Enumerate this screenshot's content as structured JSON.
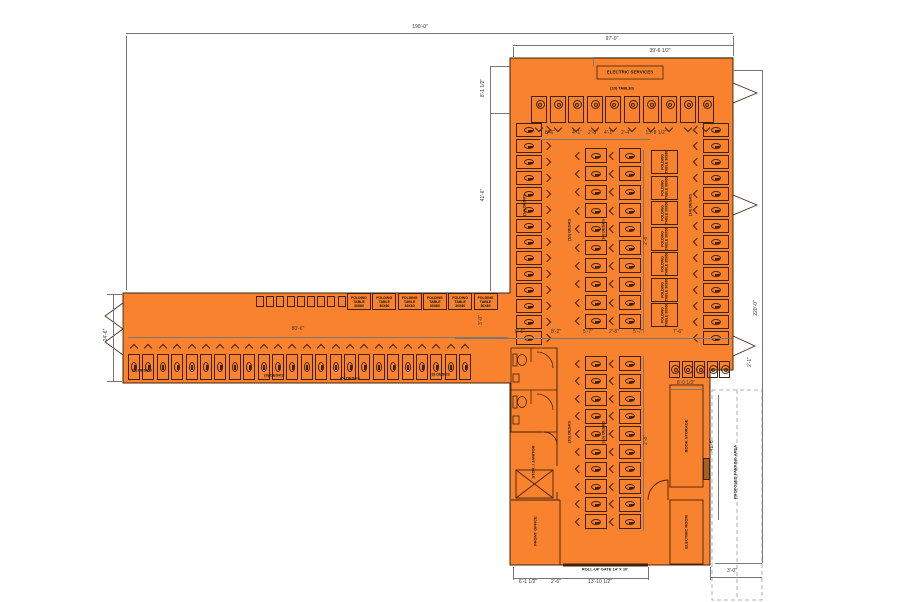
{
  "colors": {
    "building_fill": "#F9822E",
    "wall_line": "#40220a",
    "dimension_line": "#777777",
    "text": "#1a1a1a",
    "parking_dash": "#999999",
    "hatch_fill": "#A85F1F"
  },
  "room_labels": [
    {
      "t": "ELECTRIC SERVICES",
      "x": 630,
      "y": 72,
      "s": 4.5,
      "r": 0
    },
    {
      "t": "(10) TABLES",
      "x": 622,
      "y": 88,
      "s": 4,
      "r": 0
    },
    {
      "t": "ROLL-UP GATE 14' X 10'",
      "x": 605,
      "y": 569,
      "s": 4,
      "r": 0
    },
    {
      "t": "PROPOSED PARKING AREA",
      "x": 735,
      "y": 472,
      "s": 4,
      "r": -90
    },
    {
      "t": "BOOK STORAGE",
      "x": 686,
      "y": 436,
      "s": 4,
      "r": -90
    },
    {
      "t": "ELECTRIC ROOM",
      "x": 686,
      "y": 532,
      "s": 4,
      "r": -90
    },
    {
      "t": "STOR. / JANITOR",
      "x": 533,
      "y": 462,
      "s": 4,
      "r": -90
    },
    {
      "t": "FRONT OFFICE",
      "x": 535,
      "y": 531,
      "s": 4,
      "r": -90
    },
    {
      "t": "(6) DESKS",
      "x": 142,
      "y": 370,
      "s": 4,
      "r": 0
    },
    {
      "t": "(8) DESKS",
      "x": 274,
      "y": 375,
      "s": 4,
      "r": 0
    },
    {
      "t": "(5) DESKS",
      "x": 350,
      "y": 378,
      "s": 4,
      "r": 0
    },
    {
      "t": "(8) DESKS",
      "x": 440,
      "y": 374,
      "s": 4,
      "r": 0
    },
    {
      "t": "(14) DESKS",
      "x": 524,
      "y": 205,
      "s": 4,
      "r": -90
    },
    {
      "t": "(14) DESKS",
      "x": 690,
      "y": 205,
      "s": 4,
      "r": -90
    },
    {
      "t": "(10) DESKS",
      "x": 569,
      "y": 230,
      "s": 4,
      "r": -90
    },
    {
      "t": "(10) DESKS",
      "x": 603,
      "y": 230,
      "s": 4,
      "r": -90
    },
    {
      "t": "(10) DESKS",
      "x": 569,
      "y": 432,
      "s": 4,
      "r": -90
    },
    {
      "t": "(10) DESKS",
      "x": 603,
      "y": 432,
      "s": 4,
      "r": -90
    }
  ],
  "dim_labels": [
    {
      "t": "190'-0\"",
      "x": 420,
      "y": 27,
      "r": 0
    },
    {
      "t": "97'-0\"",
      "x": 612,
      "y": 39,
      "r": 0
    },
    {
      "t": "39'-6 1/2\"",
      "x": 660,
      "y": 51,
      "r": 0
    },
    {
      "t": "8'-1 1/2\"",
      "x": 483,
      "y": 88,
      "r": -90
    },
    {
      "t": "41'-6\"",
      "x": 483,
      "y": 195,
      "r": -90
    },
    {
      "t": "24'-6\"",
      "x": 106,
      "y": 335,
      "r": -90
    },
    {
      "t": "220'-0\"",
      "x": 756,
      "y": 308,
      "r": -90
    },
    {
      "t": "80'-6\"",
      "x": 298,
      "y": 329,
      "r": 0
    },
    {
      "t": "8'-6\"",
      "x": 550,
      "y": 133,
      "r": 0
    },
    {
      "t": "4'-1\"",
      "x": 577,
      "y": 133,
      "r": 0
    },
    {
      "t": "2'-8\"",
      "x": 593,
      "y": 133,
      "r": 0
    },
    {
      "t": "4'-1\"",
      "x": 609,
      "y": 133,
      "r": 0
    },
    {
      "t": "2'-4\"",
      "x": 626,
      "y": 133,
      "r": 0
    },
    {
      "t": "13'-8 1/2\"",
      "x": 656,
      "y": 133,
      "r": 0
    },
    {
      "t": "3'-0\"",
      "x": 481,
      "y": 320,
      "r": -90
    },
    {
      "t": "8'-6\"",
      "x": 520,
      "y": 332,
      "r": 0
    },
    {
      "t": "8'-2\"",
      "x": 556,
      "y": 332,
      "r": 0
    },
    {
      "t": "5'-7\"",
      "x": 588,
      "y": 332,
      "r": 0
    },
    {
      "t": "2'-8\"",
      "x": 614,
      "y": 332,
      "r": 0
    },
    {
      "t": "5'-7\"",
      "x": 638,
      "y": 332,
      "r": 0
    },
    {
      "t": "7'-6\"",
      "x": 678,
      "y": 332,
      "r": 0
    },
    {
      "t": "2'-8\"",
      "x": 646,
      "y": 240,
      "r": -90
    },
    {
      "t": "2'-8\"",
      "x": 646,
      "y": 440,
      "r": -90
    },
    {
      "t": "6'-1 1/2\"",
      "x": 528,
      "y": 582,
      "r": 0
    },
    {
      "t": "2'-6\"",
      "x": 556,
      "y": 582,
      "r": 0
    },
    {
      "t": "13'-10 1/2\"",
      "x": 600,
      "y": 582,
      "r": 0
    },
    {
      "t": "3'-0\"",
      "x": 732,
      "y": 571,
      "r": 0
    },
    {
      "t": "8'-0 1/2\"",
      "x": 686,
      "y": 383,
      "r": 0
    },
    {
      "t": "41'-6\"",
      "x": 712,
      "y": 445,
      "r": -90
    },
    {
      "t": "2'-1\"",
      "x": 750,
      "y": 362,
      "r": -90
    }
  ],
  "dim_lines": [
    {
      "x": 126,
      "y": 33,
      "len": 607,
      "dir": "h"
    },
    {
      "x": 513,
      "y": 45,
      "len": 220,
      "dir": "h"
    },
    {
      "x": 593,
      "y": 57,
      "len": 140,
      "dir": "h"
    },
    {
      "x": 126,
      "y": 36,
      "len": 254,
      "dir": "v"
    },
    {
      "x": 733,
      "y": 36,
      "len": 20,
      "dir": "v"
    },
    {
      "x": 513,
      "y": 47,
      "len": 10,
      "dir": "v"
    },
    {
      "x": 593,
      "y": 59,
      "len": 7,
      "dir": "v"
    },
    {
      "x": 490,
      "y": 66,
      "len": 47,
      "dir": "v"
    },
    {
      "x": 490,
      "y": 113,
      "len": 178,
      "dir": "v"
    },
    {
      "x": 490,
      "y": 66,
      "len": 20,
      "dir": "h"
    },
    {
      "x": 490,
      "y": 113,
      "len": 20,
      "dir": "h"
    },
    {
      "x": 113,
      "y": 295,
      "len": 86,
      "dir": "v"
    },
    {
      "x": 107,
      "y": 294,
      "len": 15,
      "dir": "h"
    },
    {
      "x": 107,
      "y": 381,
      "len": 15,
      "dir": "h"
    },
    {
      "x": 762,
      "y": 70,
      "len": 493,
      "dir": "v"
    },
    {
      "x": 733,
      "y": 70,
      "len": 29,
      "dir": "h"
    },
    {
      "x": 715,
      "y": 563,
      "len": 47,
      "dir": "h"
    },
    {
      "x": 128,
      "y": 337,
      "len": 380,
      "dir": "h"
    },
    {
      "x": 455,
      "y": 338,
      "len": 278,
      "dir": "h"
    },
    {
      "x": 540,
      "y": 139,
      "len": 110,
      "dir": "h"
    },
    {
      "x": 643,
      "y": 150,
      "len": 183,
      "dir": "v"
    },
    {
      "x": 643,
      "y": 356,
      "len": 175,
      "dir": "v"
    },
    {
      "x": 513,
      "y": 578,
      "len": 135,
      "dir": "h"
    },
    {
      "x": 513,
      "y": 567,
      "len": 13,
      "dir": "v"
    },
    {
      "x": 648,
      "y": 567,
      "len": 13,
      "dir": "v"
    },
    {
      "x": 710,
      "y": 577,
      "len": 52,
      "dir": "h"
    },
    {
      "x": 710,
      "y": 567,
      "len": 13,
      "dir": "v"
    },
    {
      "x": 670,
      "y": 389,
      "len": 33,
      "dir": "h"
    },
    {
      "x": 718,
      "y": 395,
      "len": 125,
      "dir": "v"
    }
  ],
  "furniture": {
    "rows": [
      {
        "name": "wing-desk-row",
        "type": "desk",
        "orient": "up",
        "x": 128,
        "y": 345,
        "count": 24,
        "pitch": 14.4,
        "w": 12,
        "h": 26
      },
      {
        "name": "wing-lockers",
        "type": "locker",
        "x": 256,
        "y": 296,
        "count": 9,
        "pitch": 10.2,
        "w": 8,
        "h": 11
      },
      {
        "name": "wing-folding-tables",
        "type": "htable",
        "x": 347,
        "y": 293,
        "count": 6,
        "pitch": 25.3,
        "w": 24,
        "h": 17,
        "label": "FOLDING TABLE 30X60"
      },
      {
        "name": "hall-top-tables",
        "type": "tcircle",
        "orient": "down",
        "x": 531,
        "y": 96,
        "count": 10,
        "pitch": 18.6,
        "w": 16,
        "h": 27
      },
      {
        "name": "hall-left-col",
        "type": "desk",
        "orient": "right",
        "x": 516,
        "y": 123,
        "count": 14,
        "pitch": 16,
        "w": 26,
        "h": 14
      },
      {
        "name": "hall-right-col",
        "type": "desk",
        "orient": "left",
        "x": 694,
        "y": 123,
        "count": 14,
        "pitch": 16,
        "w": 26,
        "h": 14
      },
      {
        "name": "hall-center-col1",
        "type": "desk",
        "orient": "left",
        "x": 576,
        "y": 148,
        "count": 10,
        "pitch": 18.4,
        "w": 22,
        "h": 15
      },
      {
        "name": "hall-center-col2",
        "type": "desk",
        "orient": "left",
        "x": 610,
        "y": 148,
        "count": 10,
        "pitch": 18.4,
        "w": 22,
        "h": 15
      },
      {
        "name": "hall-folding-col",
        "type": "vtable",
        "x": 651,
        "y": 150,
        "count": 7,
        "pitch": 25.5,
        "w": 27,
        "h": 24,
        "label": "FOLDING TABLE 30X60"
      },
      {
        "name": "lower-center-col1",
        "type": "desk",
        "orient": "left",
        "x": 576,
        "y": 356,
        "count": 10,
        "pitch": 17.6,
        "w": 22,
        "h": 15
      },
      {
        "name": "lower-center-col2",
        "type": "desk",
        "orient": "left",
        "x": 610,
        "y": 356,
        "count": 10,
        "pitch": 17.6,
        "w": 22,
        "h": 15
      },
      {
        "name": "lower-right-chairs",
        "type": "tcircle",
        "orient": "none",
        "x": 669,
        "y": 361,
        "count": 5,
        "pitch": 12.6,
        "w": 11,
        "h": 17
      }
    ]
  }
}
